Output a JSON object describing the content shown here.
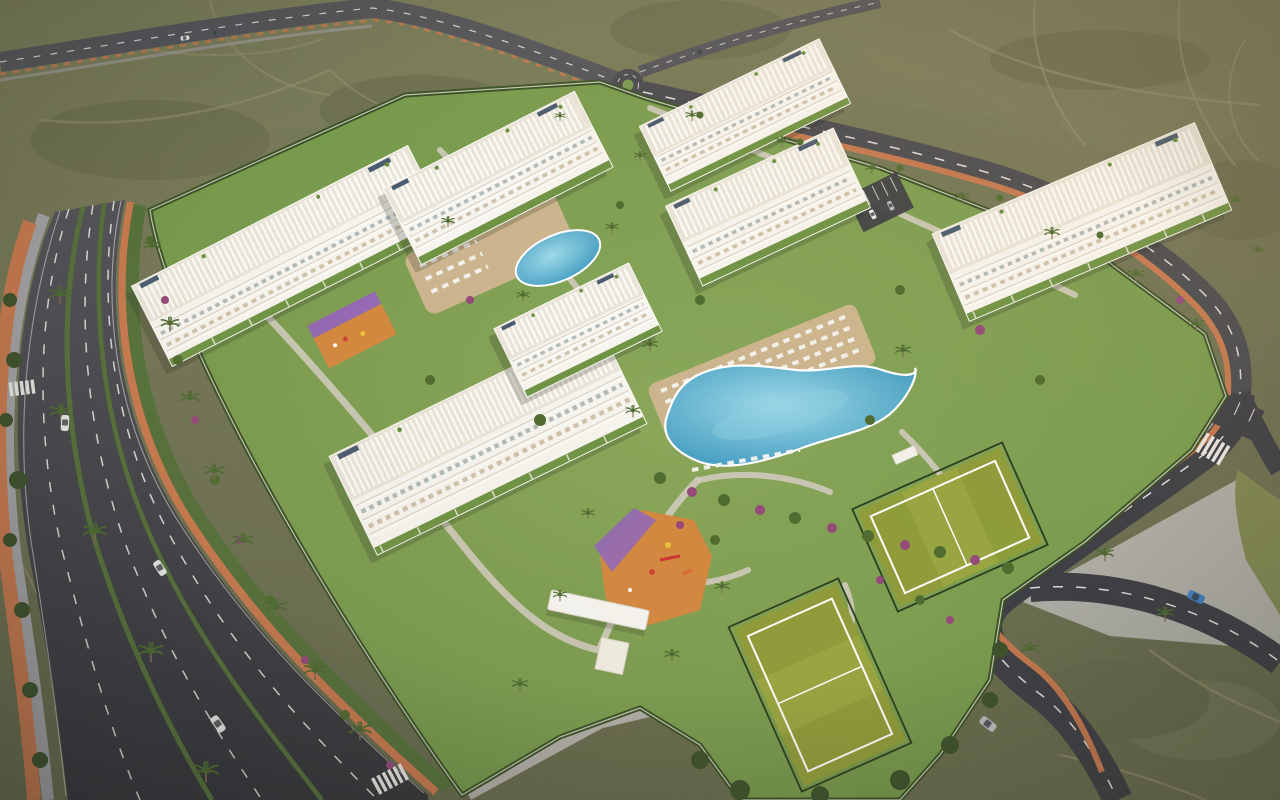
{
  "image": {
    "title": "Aerial 3D architectural render of a resort-style apartment complex",
    "description": "Aerial daytime 3D rendering of a gated residential resort: seven white low-rise apartment blocks with balconies, rooftop pergolas and solar panels set in landscaped gardens with two swimming pools, sun loungers, two padel courts, playgrounds and palm trees, bordered by a multi-lane boulevard and a perimeter road with terracotta bike lanes, surrounded by dry scrubland with dirt trails.",
    "type": "3d-render-aerial",
    "time_of_day": "late afternoon",
    "width_px": 1280,
    "height_px": 800
  },
  "palette": {
    "scrub": "#7b7e5b",
    "scrub_light": "#8a8c66",
    "scrub_dark": "#6b6e4f",
    "dirt": "#b1a583",
    "asphalt": "#45464b",
    "asphalt_far": "#54555a",
    "asphalt_near": "#3e3f45",
    "lane": "#eceae4",
    "bike": "#c8794e",
    "sidewalk": "#a3a2a6",
    "sidewalk_light": "#b8b6b2",
    "lawn": "#7da04f",
    "lawn_dark": "#63893f",
    "verge": "#55713a",
    "building": "#f6f4ee",
    "building_side": "#dcd6c8",
    "roof_deck": "#e9e4d8",
    "glass": "#a9b4b4",
    "interior_tan": "#c9b9a0",
    "pool": "#3f9cc3",
    "pool_light": "#8fd0e2",
    "deck": "#ccb58e",
    "court": "#8f9c3a",
    "court_light": "#a0ad46",
    "play_orange": "#d3883f",
    "play_purple": "#9468b4",
    "hedge": "#3a5226",
    "palm": "#4c6a30",
    "trunk": "#7a6b4f",
    "shrub_green": "#4f6b2f",
    "shrub_magenta": "#94497a",
    "tree_dark": "#3c512b",
    "solar": "#3d5166",
    "car_white": "#ebebe8",
    "car_silver": "#b9b9bc",
    "car_blue": "#3f7fc2",
    "car_dark": "#55565a",
    "path_light": "#cfcabc",
    "wall_white": "#e6e3d8"
  },
  "scene": {
    "surroundings": {
      "terrain": "dry scrubland with dirt trails",
      "roads": [
        "multi-lane boulevard with landscaped medians (left)",
        "perimeter road along top and right with curves",
        "small roundabout at the north access"
      ],
      "bike_lane_color": "terracotta orange",
      "crosswalks": 3
    },
    "complex": {
      "buildings": {
        "count": 7,
        "floors": 4,
        "style": "white low-rise blocks with balconies, rooftop pergolas and solar panels"
      },
      "pools": [
        {
          "name": "main lagoon pool",
          "loungers": true
        },
        {
          "name": "secondary pool",
          "loungers": true
        }
      ],
      "sports": {
        "padel_tennis_courts": 2,
        "surface": "green with white lines"
      },
      "playgrounds": {
        "count": 2,
        "ground_colors": [
          "orange",
          "purple"
        ]
      },
      "entrance": {
        "canopy": "white gate canopy with hut",
        "plaza": "paved"
      },
      "landscaping": [
        "lawns",
        "palm trees",
        "flowering shrubs",
        "perimeter hedge with white walls"
      ]
    },
    "vehicles": {
      "on_roads": 8,
      "parked": 2,
      "colors": [
        "white",
        "silver",
        "blue",
        "dark"
      ]
    }
  }
}
